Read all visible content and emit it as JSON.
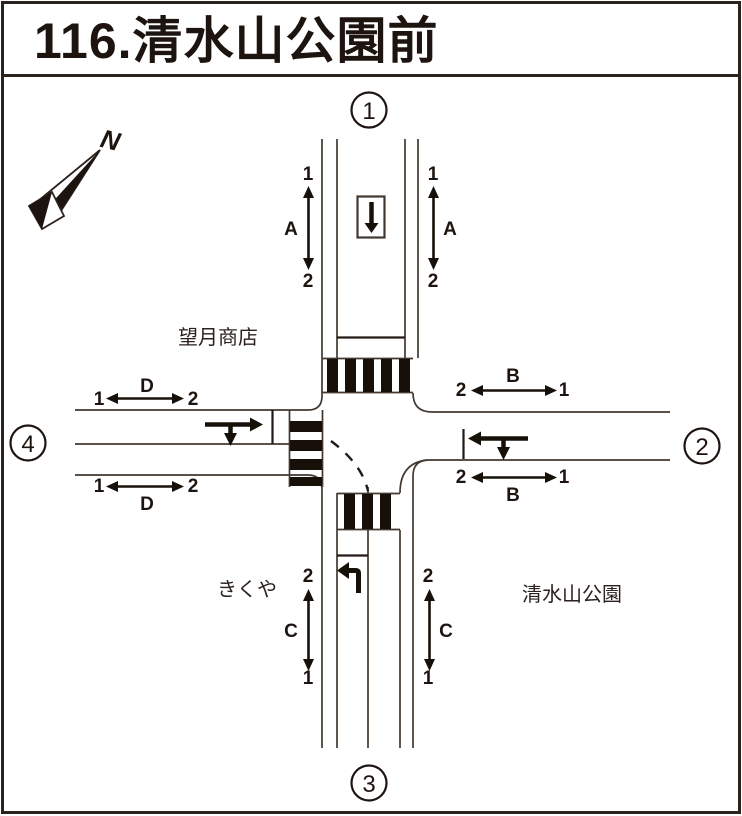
{
  "title": "116.清水山公園前",
  "compass": {
    "north_label": "N"
  },
  "intersection_numbers": {
    "north": "1",
    "east": "2",
    "south": "3",
    "west": "4"
  },
  "landmarks": {
    "northwest": "望月商店",
    "southwest": "きくや",
    "southeast": "清水山公園"
  },
  "measurements": {
    "a_left": {
      "label": "A",
      "top": "1",
      "bottom": "2"
    },
    "a_right": {
      "label": "A",
      "top": "1",
      "bottom": "2"
    },
    "b_top": {
      "label": "B",
      "left": "2",
      "right": "1"
    },
    "b_bottom": {
      "label": "B",
      "left": "2",
      "right": "1"
    },
    "c_left": {
      "label": "C",
      "top": "2",
      "bottom": "1"
    },
    "c_right": {
      "label": "C",
      "top": "2",
      "bottom": "1"
    },
    "d_top": {
      "label": "D",
      "left": "1",
      "right": "2"
    },
    "d_bottom": {
      "label": "D",
      "left": "1",
      "right": "2"
    }
  }
}
